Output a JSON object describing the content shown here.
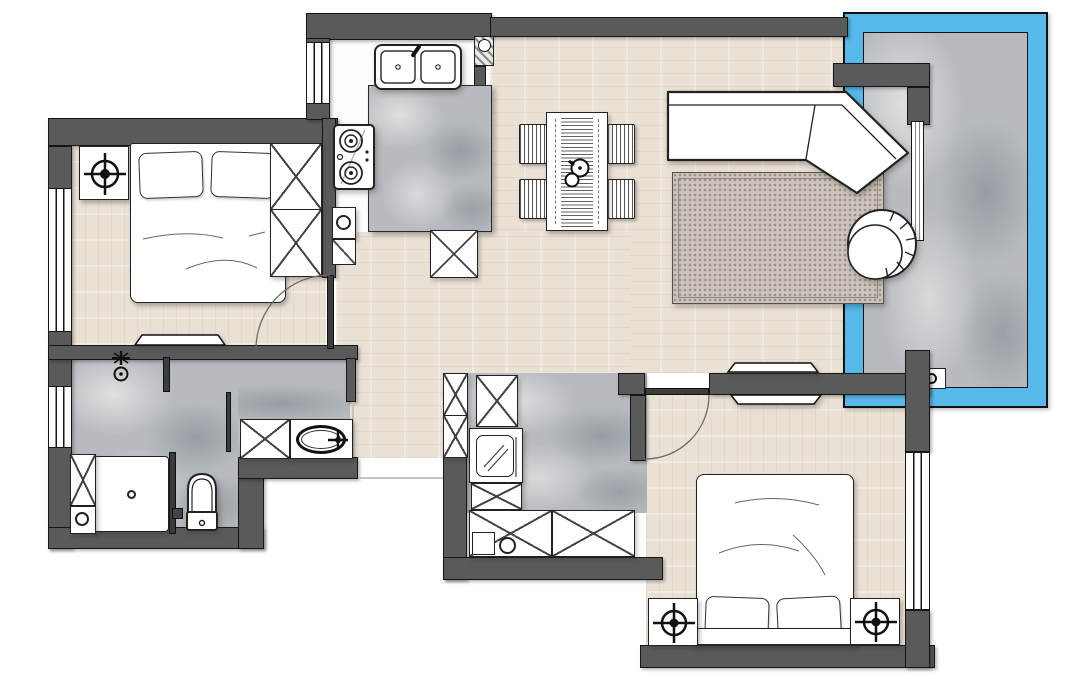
{
  "plan": {
    "type": "apartment-floor-plan",
    "palette": {
      "wall": "#5a5a5a",
      "line": "#161616",
      "wood": "#eae1d5",
      "marble": "#b7bbbf",
      "rug": "#ccc4ba",
      "glass_blue": "#57b8ea",
      "furniture_fill": "#ffffff",
      "background": "#ffffff"
    },
    "rooms": [
      {
        "name": "bedroom-1",
        "floor": "wood",
        "symbols": [
          "double-bed",
          "pillows",
          "nightstand",
          "ceiling-light-symbol",
          "wardrobe",
          "tv",
          "swing-door",
          "window"
        ]
      },
      {
        "name": "kitchen",
        "floor": "tile",
        "symbols": [
          "double-sink",
          "faucet",
          "gas-stove",
          "marble-counter",
          "base-cabinet",
          "tall-cabinet",
          "window"
        ]
      },
      {
        "name": "living-dining",
        "floor": "wood",
        "symbols": [
          "dining-table",
          "table-runner",
          "teapot",
          "dining-chair",
          "dining-chair",
          "dining-chair",
          "dining-chair",
          "corner-sofa",
          "area-rug",
          "round-lounge-chair",
          "tv",
          "service-column"
        ]
      },
      {
        "name": "balcony",
        "floor": "marble",
        "symbols": [
          "glazed-frame",
          "floor-drain",
          "window",
          "wall-return"
        ]
      },
      {
        "name": "bathroom",
        "floor": "marble",
        "symbols": [
          "shower-tray",
          "shower-head",
          "glass-screen",
          "toilet",
          "floor-drain",
          "vanity-cabinet",
          "oval-basin",
          "faucet",
          "storage-cabinet",
          "laundry-basket",
          "window"
        ]
      },
      {
        "name": "utility-laundry",
        "floor": "marble",
        "symbols": [
          "washing-machine",
          "tall-cabinet",
          "storage-cabinet",
          "counter-cabinets",
          "small-sink"
        ]
      },
      {
        "name": "bedroom-2",
        "floor": "wood",
        "symbols": [
          "double-bed",
          "pillows",
          "headboard",
          "nightstand",
          "nightstand",
          "ceiling-light-symbol",
          "ceiling-light-symbol",
          "tv",
          "swing-door",
          "window"
        ]
      }
    ]
  }
}
